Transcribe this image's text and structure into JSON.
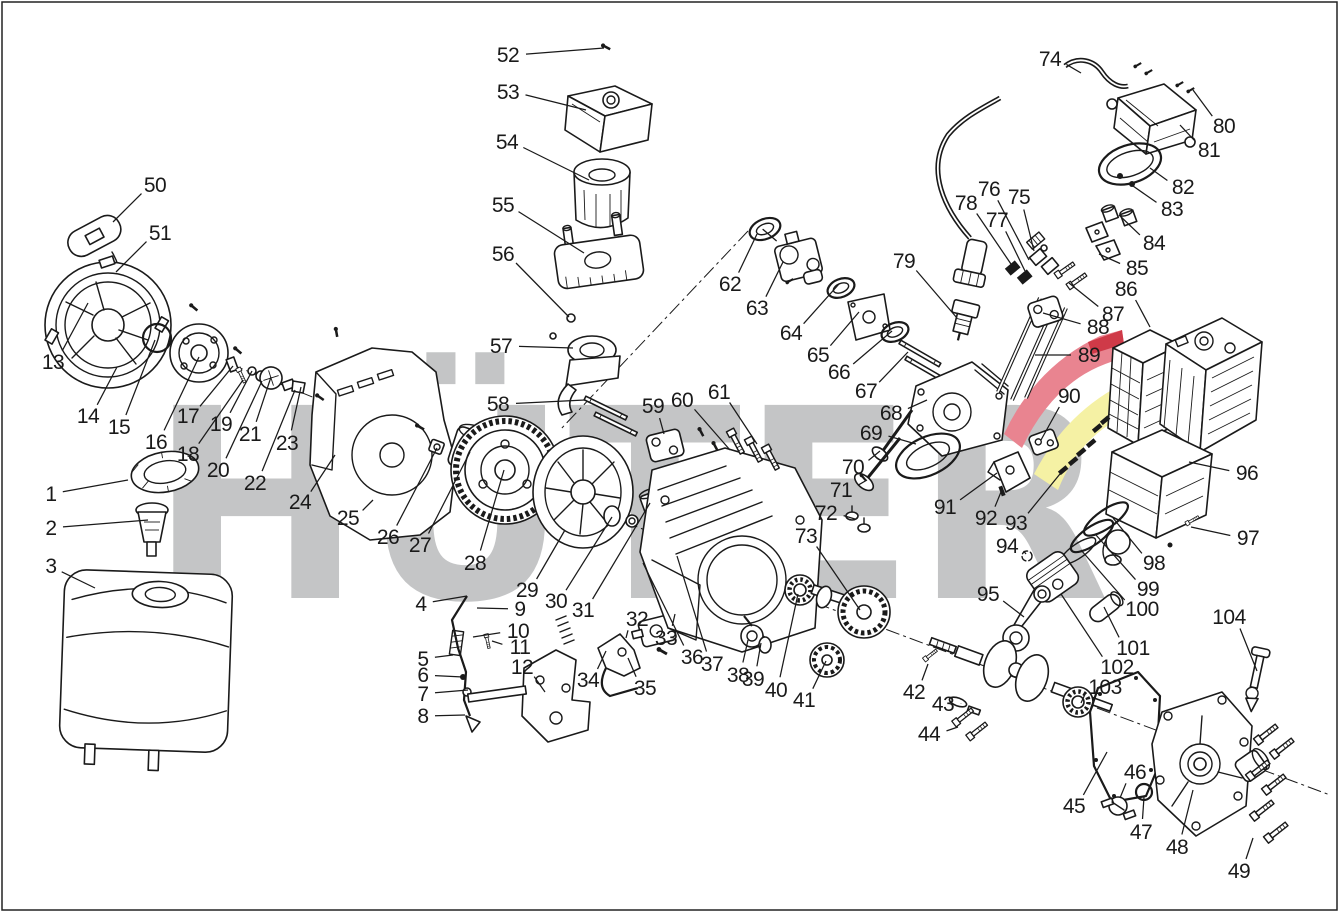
{
  "colors": {
    "ink": "#1a1a1a",
    "background": "#ffffff",
    "watermark_gray": "#c4c5c6",
    "swoosh_red": "#e98490",
    "swoosh_dark_red": "#cf3a48",
    "swoosh_yellow": "#f5f1a4"
  },
  "watermark": {
    "text": "HÜTER"
  },
  "diagram": {
    "type": "exploded-parts-diagram",
    "callout_count": 104,
    "callouts": [
      [
        1,
        51,
        494,
        128,
        480
      ],
      [
        2,
        51,
        528,
        148,
        520
      ],
      [
        3,
        51,
        566,
        95,
        588
      ],
      [
        4,
        421,
        604,
        467,
        596
      ],
      [
        5,
        423,
        659,
        453,
        655
      ],
      [
        6,
        423,
        675,
        463,
        677
      ],
      [
        7,
        423,
        694,
        468,
        690
      ],
      [
        8,
        423,
        716,
        465,
        715
      ],
      [
        9,
        520,
        609,
        477,
        608
      ],
      [
        10,
        518,
        631,
        473,
        637
      ],
      [
        11,
        520,
        647,
        492,
        641
      ],
      [
        12,
        522,
        667,
        545,
        692
      ],
      [
        13,
        53,
        362,
        88,
        303
      ],
      [
        14,
        88,
        416,
        117,
        367
      ],
      [
        15,
        119,
        427,
        155,
        340
      ],
      [
        16,
        156,
        442,
        199,
        357
      ],
      [
        17,
        188,
        416,
        233,
        366
      ],
      [
        18,
        188,
        454,
        243,
        380
      ],
      [
        19,
        221,
        424,
        252,
        371
      ],
      [
        20,
        218,
        470,
        262,
        381
      ],
      [
        21,
        250,
        434,
        271,
        377
      ],
      [
        22,
        255,
        483,
        295,
        390
      ],
      [
        23,
        287,
        443,
        301,
        387
      ],
      [
        24,
        300,
        502,
        335,
        455
      ],
      [
        25,
        348,
        518,
        373,
        500
      ],
      [
        26,
        388,
        537,
        437,
        448
      ],
      [
        27,
        420,
        545,
        470,
        452
      ],
      [
        28,
        475,
        563,
        504,
        470
      ],
      [
        29,
        527,
        590,
        565,
        530
      ],
      [
        30,
        556,
        601,
        612,
        517
      ],
      [
        31,
        583,
        610,
        650,
        503
      ],
      [
        32,
        637,
        619,
        626,
        638
      ],
      [
        33,
        666,
        638,
        675,
        614
      ],
      [
        34,
        588,
        680,
        606,
        651
      ],
      [
        35,
        645,
        688,
        628,
        658
      ],
      [
        36,
        692,
        657,
        643,
        563
      ],
      [
        37,
        712,
        664,
        677,
        556
      ],
      [
        38,
        738,
        675,
        748,
        640
      ],
      [
        39,
        753,
        679,
        761,
        643
      ],
      [
        40,
        776,
        690,
        798,
        594
      ],
      [
        41,
        804,
        700,
        826,
        661
      ],
      [
        42,
        914,
        692,
        928,
        664
      ],
      [
        43,
        943,
        704,
        961,
        703
      ],
      [
        44,
        929,
        734,
        958,
        727
      ],
      [
        45,
        1074,
        806,
        1107,
        752
      ],
      [
        46,
        1135,
        772,
        1120,
        798
      ],
      [
        47,
        1141,
        832,
        1144,
        797
      ],
      [
        48,
        1177,
        847,
        1193,
        790
      ],
      [
        49,
        1239,
        871,
        1253,
        838
      ],
      [
        50,
        155,
        185,
        113,
        222
      ],
      [
        51,
        160,
        233,
        116,
        272
      ],
      [
        52,
        508,
        55,
        604,
        48
      ],
      [
        53,
        508,
        92,
        586,
        110
      ],
      [
        54,
        507,
        142,
        589,
        180
      ],
      [
        55,
        503,
        205,
        584,
        253
      ],
      [
        56,
        503,
        254,
        569,
        317
      ],
      [
        57,
        501,
        346,
        573,
        348
      ],
      [
        58,
        498,
        404,
        585,
        400
      ],
      [
        59,
        653,
        406,
        664,
        434
      ],
      [
        60,
        682,
        400,
        730,
        450
      ],
      [
        61,
        719,
        392,
        757,
        444
      ],
      [
        62,
        730,
        284,
        757,
        234
      ],
      [
        63,
        757,
        308,
        783,
        262
      ],
      [
        64,
        791,
        333,
        839,
        284
      ],
      [
        65,
        818,
        355,
        859,
        312
      ],
      [
        66,
        839,
        372,
        892,
        331
      ],
      [
        67,
        866,
        391,
        908,
        352
      ],
      [
        68,
        891,
        413,
        927,
        400
      ],
      [
        69,
        871,
        433,
        916,
        444
      ],
      [
        70,
        853,
        467,
        880,
        451
      ],
      [
        71,
        841,
        490,
        867,
        480
      ],
      [
        72,
        826,
        513,
        855,
        519
      ],
      [
        73,
        806,
        536,
        860,
        610
      ],
      [
        74,
        1050,
        59,
        1081,
        73
      ],
      [
        75,
        1019,
        197,
        1034,
        251
      ],
      [
        76,
        989,
        189,
        1029,
        260
      ],
      [
        77,
        997,
        220,
        1025,
        271
      ],
      [
        78,
        966,
        203,
        1013,
        267
      ],
      [
        79,
        904,
        261,
        957,
        318
      ],
      [
        80,
        1224,
        126,
        1193,
        90
      ],
      [
        81,
        1209,
        150,
        1180,
        125
      ],
      [
        82,
        1183,
        187,
        1150,
        168
      ],
      [
        83,
        1172,
        209,
        1133,
        186
      ],
      [
        84,
        1154,
        243,
        1119,
        215
      ],
      [
        85,
        1137,
        268,
        1099,
        254
      ],
      [
        86,
        1126,
        289,
        1150,
        327
      ],
      [
        87,
        1113,
        314,
        1069,
        283
      ],
      [
        88,
        1098,
        327,
        1043,
        313
      ],
      [
        89,
        1089,
        355,
        1035,
        355
      ],
      [
        90,
        1069,
        396,
        1041,
        440
      ],
      [
        91,
        945,
        507,
        997,
        473
      ],
      [
        92,
        986,
        518,
        1001,
        492
      ],
      [
        93,
        1016,
        523,
        1064,
        469
      ],
      [
        94,
        1007,
        546,
        1026,
        554
      ],
      [
        95,
        988,
        594,
        1024,
        617
      ],
      [
        96,
        1247,
        473,
        1189,
        462
      ],
      [
        97,
        1248,
        538,
        1191,
        527
      ],
      [
        98,
        1154,
        563,
        1113,
        518
      ],
      [
        99,
        1148,
        589,
        1096,
        535
      ],
      [
        100,
        1142,
        609,
        1081,
        550
      ],
      [
        101,
        1133,
        648,
        1104,
        607
      ],
      [
        102,
        1117,
        667,
        1061,
        594
      ],
      [
        103,
        1105,
        687,
        1081,
        703
      ],
      [
        104,
        1229,
        617,
        1257,
        671
      ]
    ]
  }
}
